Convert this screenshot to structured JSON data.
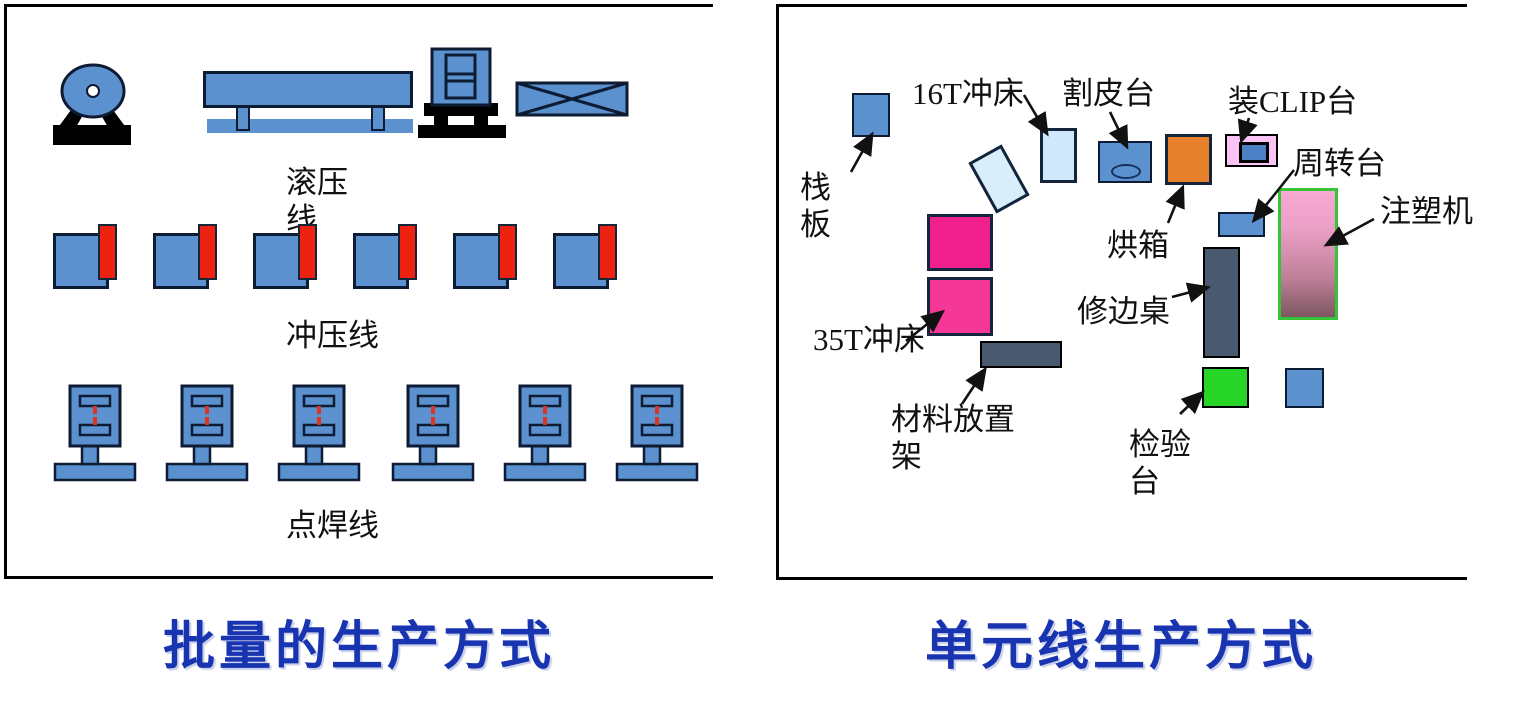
{
  "left_panel": {
    "caption": "批量的生产方式",
    "rolling_line_label": "滚压线",
    "stamping_line_label": "冲压线",
    "welding_line_label": "点焊线"
  },
  "right_panel": {
    "caption": "单元线生产方式",
    "labels": {
      "pallet": "栈板",
      "press_16t": "16T冲床",
      "skin_cutting": "割皮台",
      "clip_station": "装CLIP台",
      "turnover": "周转台",
      "injection_molding": "注塑机",
      "oven": "烘箱",
      "trimming_table": "修边桌",
      "press_35t": "35T冲床",
      "material_rack": "材料放置架",
      "inspection": "检验台"
    }
  },
  "colors": {
    "machine_blue": "#5b91ce",
    "accent_red": "#ee2211",
    "hot_pink": "#f0218f",
    "oven_orange": "#e6802a",
    "light_blue": "#cfe9fa",
    "clip_pink": "#f9c4f3",
    "inspection_green": "#27d527",
    "rack_slate": "#49596f",
    "injection_top": "#f7abd4",
    "injection_bottom": "#7d5761",
    "injection_border": "#35c435",
    "caption_blue": "#1834b0"
  }
}
